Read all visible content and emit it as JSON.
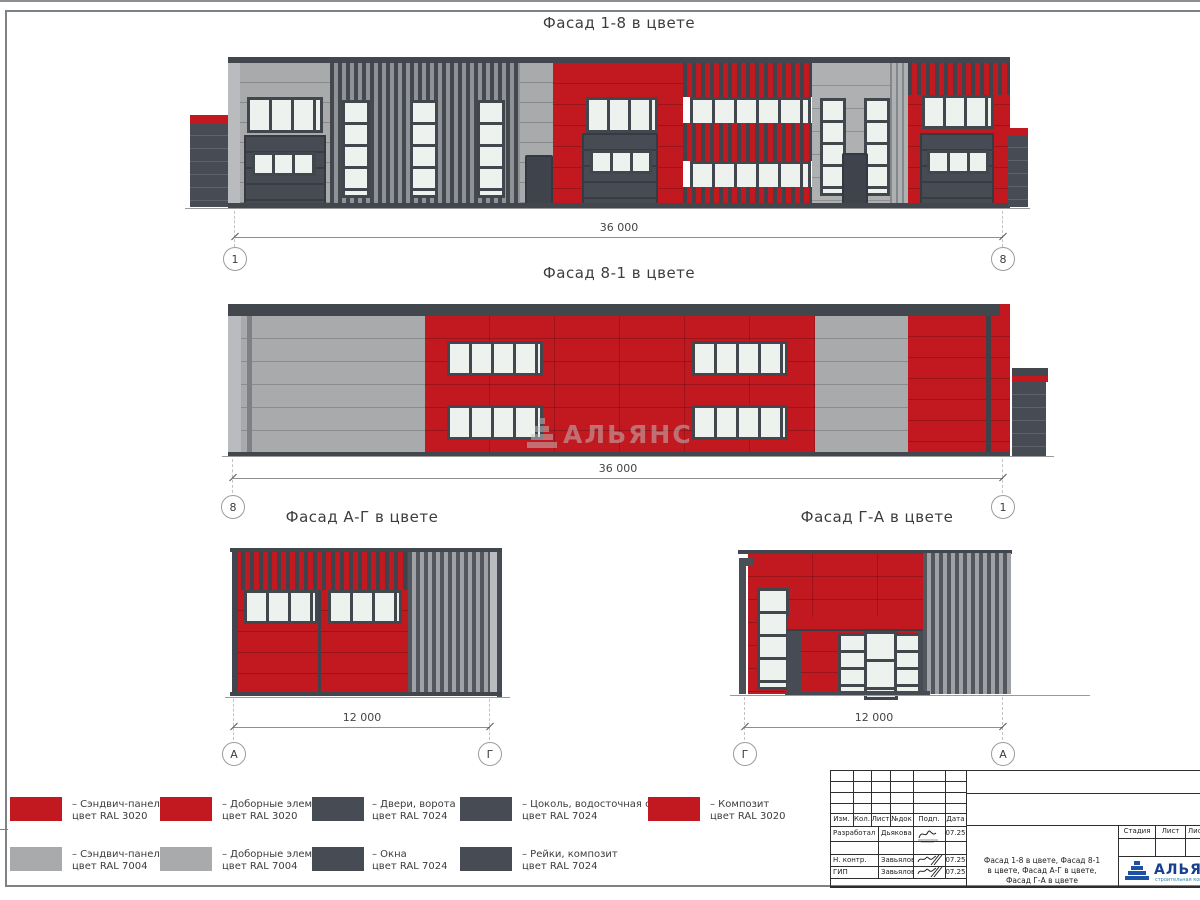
{
  "titles": {
    "f1": "Фасад 1-8 в цвете",
    "f2": "Фасад 8-1 в цвете",
    "f3": "Фасад А-Г в цвете",
    "f4": "Фасад Г-А в цвете"
  },
  "dims": {
    "f1": "36 000",
    "f2": "36 000",
    "f3": "12 000",
    "f4": "12 000"
  },
  "axes": {
    "f1_left": "1",
    "f1_right": "8",
    "f2_left": "8",
    "f2_right": "1",
    "f3_left": "А",
    "f3_right": "Г",
    "f4_left": "Г",
    "f4_right": "А"
  },
  "watermark": {
    "text": "АЛЬЯНС"
  },
  "colors": {
    "red_ral3020": "#c1191f",
    "gray_ral7004": "#a8aaac",
    "dark_ral7024": "#474b53",
    "glass": "#edf2ef",
    "logo_blue": "#1d51a3"
  },
  "legend": {
    "items": [
      {
        "swatch": "red",
        "label": "– Сэндвич-панели\nцвет RAL 3020"
      },
      {
        "swatch": "red",
        "label": "– Доборные элементы\nцвет RAL 3020"
      },
      {
        "swatch": "dark",
        "label": "– Двери, ворота\nцвет RAL 7024"
      },
      {
        "swatch": "dark",
        "label": "– Цоколь, водосточная система\nцвет RAL 7024"
      },
      {
        "swatch": "red",
        "label": "– Композит\nцвет RAL 3020"
      },
      {
        "swatch": "gray",
        "label": "– Сэндвич-панели\nцвет RAL 7004"
      },
      {
        "swatch": "gray",
        "label": "– Доборные элементы\nцвет RAL 7004"
      },
      {
        "swatch": "dark",
        "label": "– Окна\nцвет RAL 7024"
      },
      {
        "swatch": "dark",
        "label": "– Рейки, композит\nцвет RAL 7024"
      }
    ]
  },
  "stamp": {
    "head": {
      "izm": "Изм.",
      "kol": "Кол.",
      "list": "Лист",
      "ndok": "№док",
      "podp": "Подп.",
      "data": "Дата"
    },
    "rows": [
      {
        "role": "Разработал",
        "name": "Дьякова",
        "date": "07.25"
      },
      {
        "role": "Н. контр.",
        "name": "Завьялова",
        "date": "07.25"
      },
      {
        "role": "ГИП",
        "name": "Завьялова",
        "date": "07.25"
      }
    ],
    "content": "Фасад 1-8 в цвете, Фасад 8-1\nв цвете, Фасад А-Г в цвете,\nФасад Г-А в цвете",
    "stage": {
      "stadia": "Стадия",
      "list": "Лист",
      "listov": "Листов"
    },
    "logo": {
      "text": "АЛЬЯНС",
      "sub": "строительная компания"
    }
  }
}
